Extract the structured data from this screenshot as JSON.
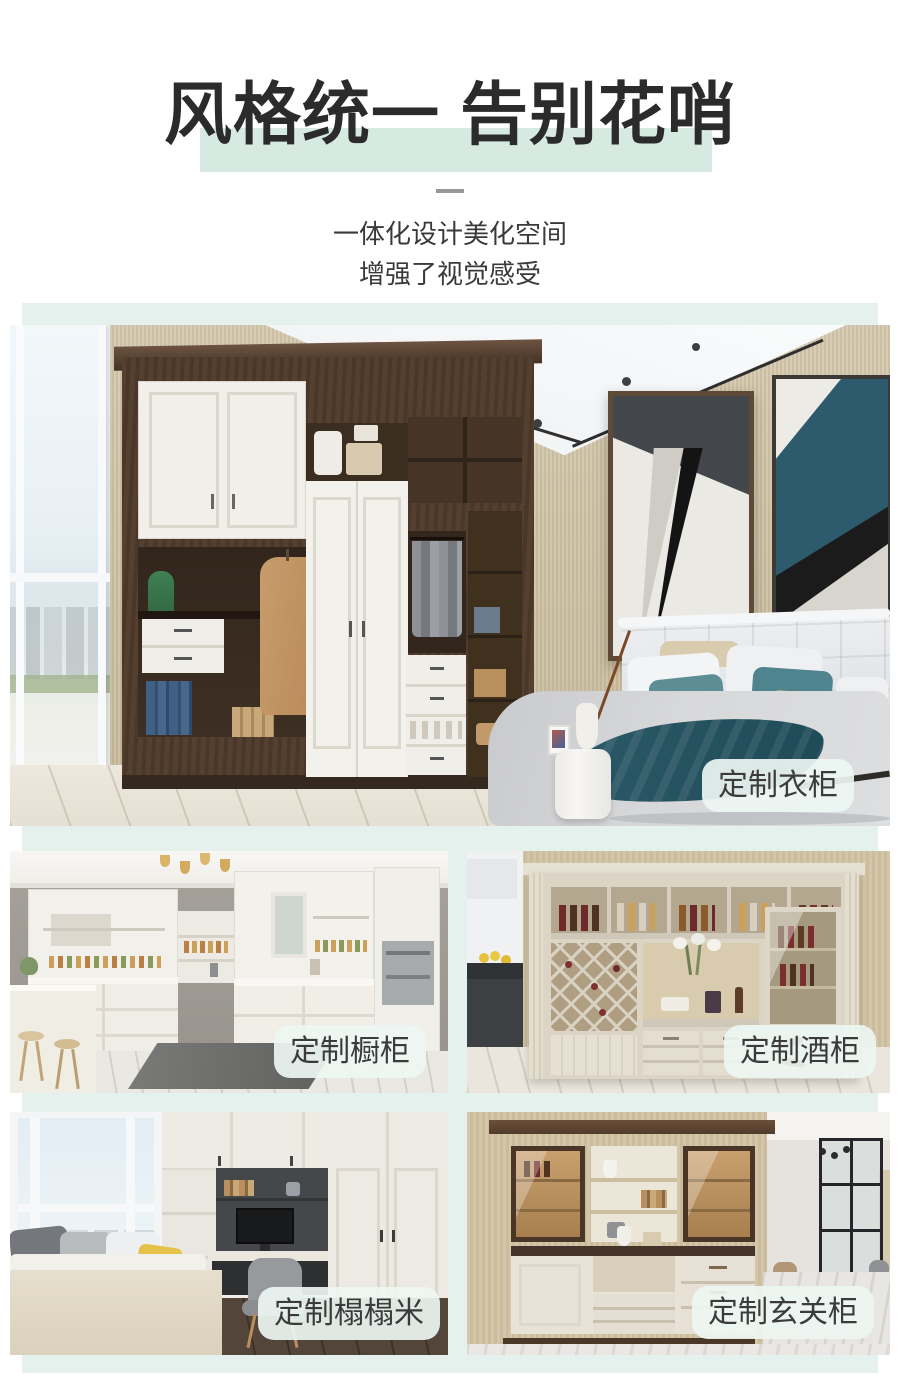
{
  "header": {
    "title": "风格统一 告别花哨",
    "subtitle_line1": "一体化设计美化空间",
    "subtitle_line2": "增强了视觉感受"
  },
  "theme": {
    "section_mint": "#e4f1ed",
    "title_highlight": "#d7eae2",
    "badge_background": "rgba(237,246,242,0.92)",
    "title_color": "#2b2b2b"
  },
  "gallery": {
    "items": [
      {
        "id": "wardrobe",
        "label": "定制衣柜"
      },
      {
        "id": "kitchen",
        "label": "定制橱柜"
      },
      {
        "id": "wine",
        "label": "定制酒柜"
      },
      {
        "id": "tatami",
        "label": "定制榻榻米"
      },
      {
        "id": "entry",
        "label": "定制玄关柜"
      }
    ]
  }
}
